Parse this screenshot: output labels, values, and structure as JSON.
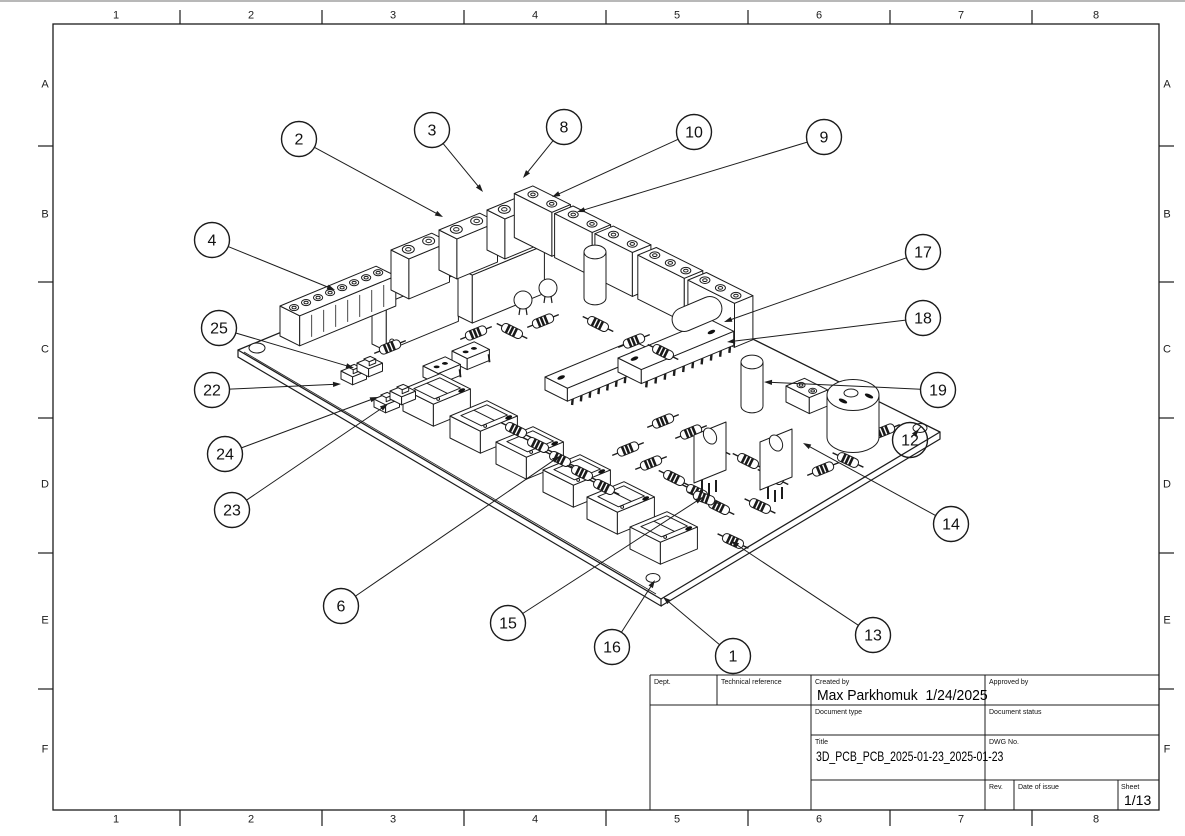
{
  "page": {
    "background": "#ffffff",
    "line_color": "#1c1c1c"
  },
  "grid": {
    "columns": [
      "1",
      "2",
      "3",
      "4",
      "5",
      "6",
      "7",
      "8"
    ],
    "rows": [
      "A",
      "B",
      "C",
      "D",
      "E",
      "F"
    ]
  },
  "balloons": [
    {
      "n": "1",
      "cx": 733,
      "cy": 656,
      "tx": 663,
      "ty": 597
    },
    {
      "n": "2",
      "cx": 299,
      "cy": 139,
      "tx": 443,
      "ty": 217
    },
    {
      "n": "3",
      "cx": 432,
      "cy": 130,
      "tx": 483,
      "ty": 192
    },
    {
      "n": "4",
      "cx": 212,
      "cy": 240,
      "tx": 335,
      "ty": 290
    },
    {
      "n": "6",
      "cx": 341,
      "cy": 606,
      "tx": 560,
      "ty": 456
    },
    {
      "n": "8",
      "cx": 564,
      "cy": 127,
      "tx": 523,
      "ty": 178
    },
    {
      "n": "9",
      "cx": 824,
      "cy": 137,
      "tx": 577,
      "ty": 212
    },
    {
      "n": "10",
      "cx": 694,
      "cy": 132,
      "tx": 552,
      "ty": 197
    },
    {
      "n": "12",
      "cx": 910,
      "cy": 440,
      "tx": 919,
      "ty": 429
    },
    {
      "n": "13",
      "cx": 873,
      "cy": 635,
      "tx": 731,
      "ty": 541
    },
    {
      "n": "14",
      "cx": 951,
      "cy": 524,
      "tx": 803,
      "ty": 443
    },
    {
      "n": "15",
      "cx": 508,
      "cy": 623,
      "tx": 703,
      "ty": 497
    },
    {
      "n": "16",
      "cx": 612,
      "cy": 647,
      "tx": 655,
      "ty": 580
    },
    {
      "n": "17",
      "cx": 923,
      "cy": 252,
      "tx": 724,
      "ty": 322
    },
    {
      "n": "18",
      "cx": 923,
      "cy": 318,
      "tx": 727,
      "ty": 342
    },
    {
      "n": "19",
      "cx": 938,
      "cy": 390,
      "tx": 764,
      "ty": 382
    },
    {
      "n": "22",
      "cx": 212,
      "cy": 390,
      "tx": 341,
      "ty": 384
    },
    {
      "n": "23",
      "cx": 232,
      "cy": 510,
      "tx": 388,
      "ty": 404
    },
    {
      "n": "24",
      "cx": 225,
      "cy": 454,
      "tx": 378,
      "ty": 397
    },
    {
      "n": "25",
      "cx": 219,
      "cy": 328,
      "tx": 354,
      "ty": 368
    }
  ],
  "title_block": {
    "dept_label": "Dept.",
    "technical_reference_label": "Technical reference",
    "created_by_label": "Created by",
    "created_by_value": "Max Parkhomuk  1/24/2025",
    "approved_by_label": "Approved by",
    "document_type_label": "Document type",
    "document_status_label": "Document status",
    "title_label": "Title",
    "title_value": "3D_PCB_PCB_2025-01-23_2025-01-23",
    "dwg_no_label": "DWG No.",
    "rev_label": "Rev.",
    "date_of_issue_label": "Date of issue",
    "sheet_label": "Sheet",
    "sheet_value": "1/13"
  }
}
